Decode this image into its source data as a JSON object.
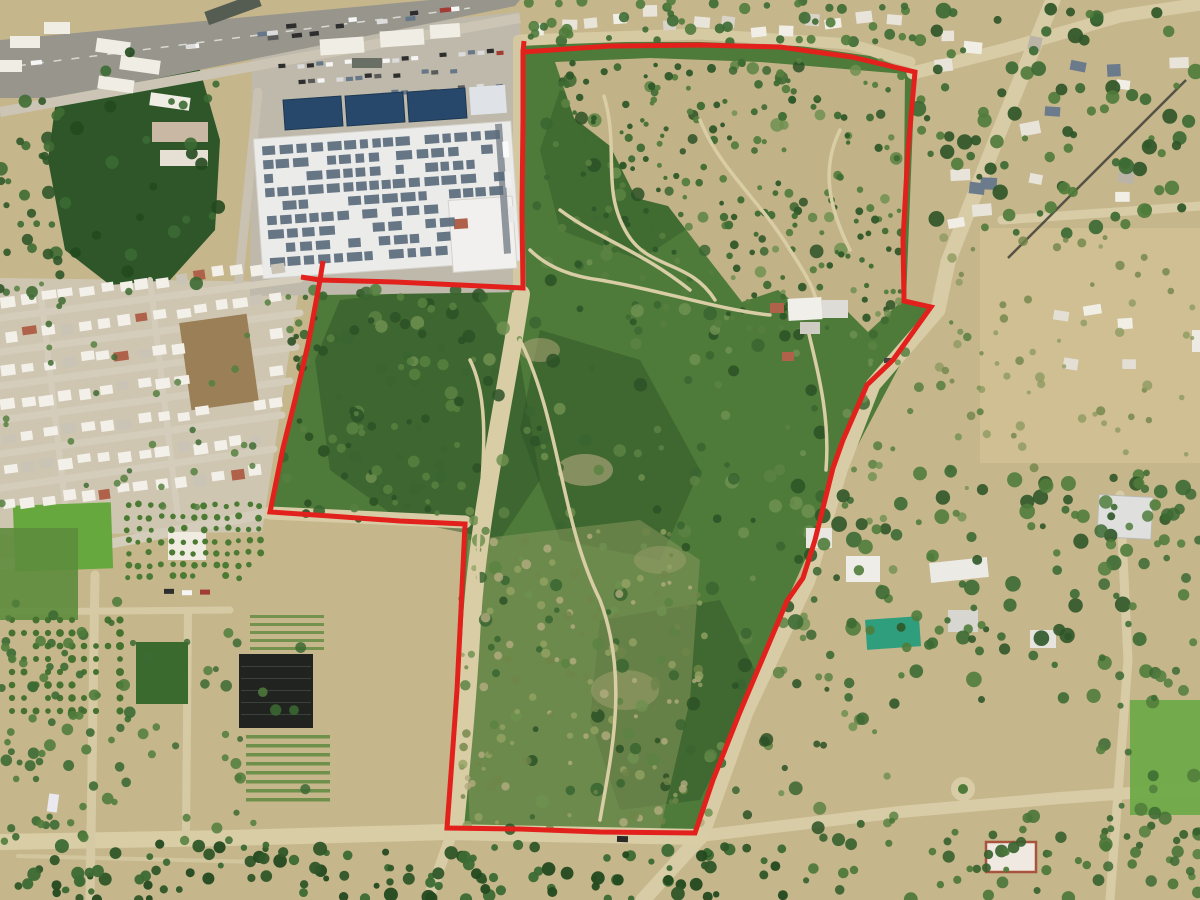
{
  "image": {
    "kind": "aerial-drone-photograph",
    "subject": "land parcel outlined with red survey boundary",
    "width_px": 1200,
    "height_px": 900
  },
  "boundary": {
    "color": "#e2211c",
    "stroke_width": 5,
    "polygon": [
      [
        523,
        52
      ],
      [
        610,
        46
      ],
      [
        700,
        45
      ],
      [
        780,
        47
      ],
      [
        852,
        57
      ],
      [
        915,
        72
      ],
      [
        908,
        150
      ],
      [
        903,
        240
      ],
      [
        904,
        301
      ],
      [
        931,
        307
      ],
      [
        893,
        360
      ],
      [
        867,
        385
      ],
      [
        843,
        440
      ],
      [
        833,
        468
      ],
      [
        815,
        540
      ],
      [
        803,
        578
      ],
      [
        787,
        601
      ],
      [
        762,
        660
      ],
      [
        740,
        712
      ],
      [
        713,
        780
      ],
      [
        695,
        833
      ],
      [
        600,
        832
      ],
      [
        520,
        829
      ],
      [
        447,
        828
      ],
      [
        452,
        760
      ],
      [
        457,
        690
      ],
      [
        461,
        610
      ],
      [
        465,
        524
      ],
      [
        400,
        521
      ],
      [
        330,
        516
      ],
      [
        270,
        512
      ],
      [
        283,
        448
      ],
      [
        295,
        400
      ],
      [
        308,
        345
      ],
      [
        320,
        280
      ],
      [
        395,
        282
      ],
      [
        460,
        285
      ],
      [
        523,
        288
      ],
      [
        522,
        210
      ],
      [
        523,
        120
      ]
    ],
    "ticks": [
      [
        [
          320,
          280
        ],
        [
          323,
          261
        ]
      ],
      [
        [
          320,
          280
        ],
        [
          301,
          277
        ]
      ],
      [
        [
          523,
          52
        ],
        [
          524,
          41
        ]
      ]
    ]
  },
  "palette": {
    "sand": "#c6b68c",
    "dirt_road": "#d8cba3",
    "scrub_green": "#4e7a3a",
    "scrub_dark": "#2f5529",
    "dry_scrub": "#95a263",
    "highway_asphalt": "#97958c",
    "warehouse_roof": "#ebebe9",
    "solar_panel": "#5a6b7c",
    "solar_canopy": "#27486b",
    "house_roof": "#f3f0e9",
    "terracotta": "#b0614a",
    "greenhouse": "#2f9e7c",
    "shade_structure": "#20231f",
    "lawn": "#67a83e"
  },
  "features": [
    "highway",
    "warehouse with rooftop solar panels",
    "solar carport canopies",
    "residential grid neighborhood",
    "orchard and nursery farms",
    "scrubland parcel",
    "sand hill with trails",
    "inner compound",
    "dirt roads",
    "rural homesteads",
    "greenhouse",
    "roundabout"
  ]
}
